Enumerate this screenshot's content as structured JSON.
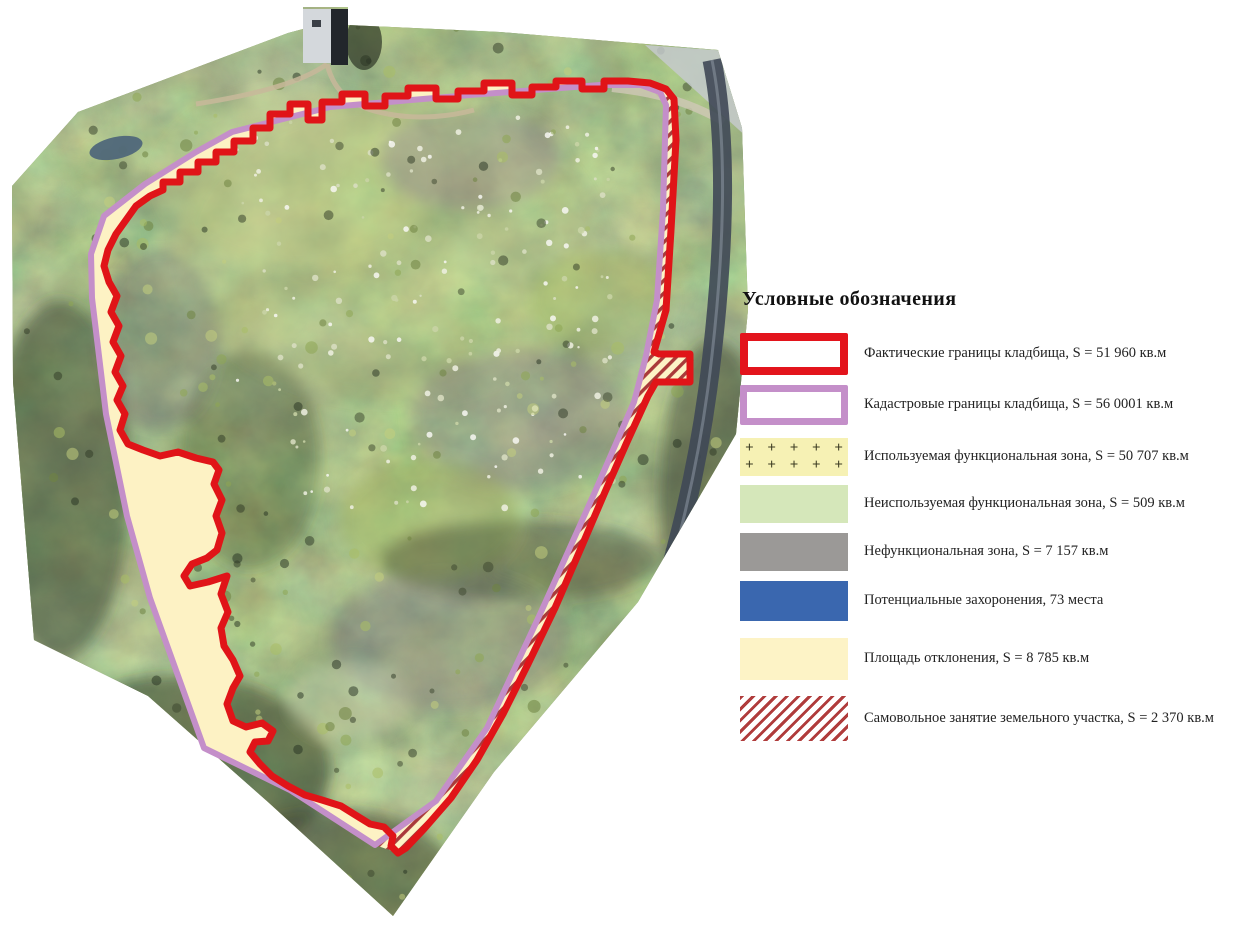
{
  "figure": {
    "background": "#ffffff"
  },
  "legend": {
    "title": "Условные обозначения",
    "items": [
      {
        "key": "actual-boundary",
        "swatch": "red-outline",
        "label": "Фактические границы кладбища, S = 51 960 кв.м"
      },
      {
        "key": "cadastral-boundary",
        "swatch": "purple-outline",
        "label": "Кадастровые границы кладбища, S = 56 0001 кв.м"
      },
      {
        "key": "used-functional-zone",
        "swatch": "plus-pattern",
        "label": "Используемая функциональная зона, S = 50 707 кв.м"
      },
      {
        "key": "unused-functional-zone",
        "swatch": "green-fill",
        "label": "Неиспользуемая функциональная зона, S = 509 кв.м"
      },
      {
        "key": "nonfunctional-zone",
        "swatch": "gray-fill",
        "label": "Нефункциональная зона, S = 7 157 кв.м"
      },
      {
        "key": "potential-burials",
        "swatch": "blue-fill",
        "label": "Потенциальные захоронения, 73 места"
      },
      {
        "key": "deviation-area",
        "swatch": "yellow-fill",
        "label": "Площадь отклонения, S = 8 785 кв.м"
      },
      {
        "key": "unauthorized-occupation",
        "swatch": "red-hatch",
        "label": "Самовольное занятие земельного участка, S = 2 370 кв.м"
      }
    ],
    "colors": {
      "actual_boundary_red": "#e3141c",
      "cadastral_boundary_purple": "#c48fc9",
      "used_zone_background": "#f6f1b4",
      "unused_zone_green": "#d5e7ba",
      "nonfunctional_zone_gray": "#9b9997",
      "potential_burials_blue": "#3a67af",
      "deviation_yellow": "#fdf3c6",
      "hatch_red": "#b03c3c"
    }
  },
  "map": {
    "overlay_colors": {
      "actual_boundary_line": "#e01418",
      "cadastral_boundary_line": "#c48fc9",
      "deviation_fill": "#fdf2c4",
      "unauthorized_hatch_stripe": "#a93a3a",
      "unauthorized_hatch_background": "#fdf3c6"
    }
  }
}
